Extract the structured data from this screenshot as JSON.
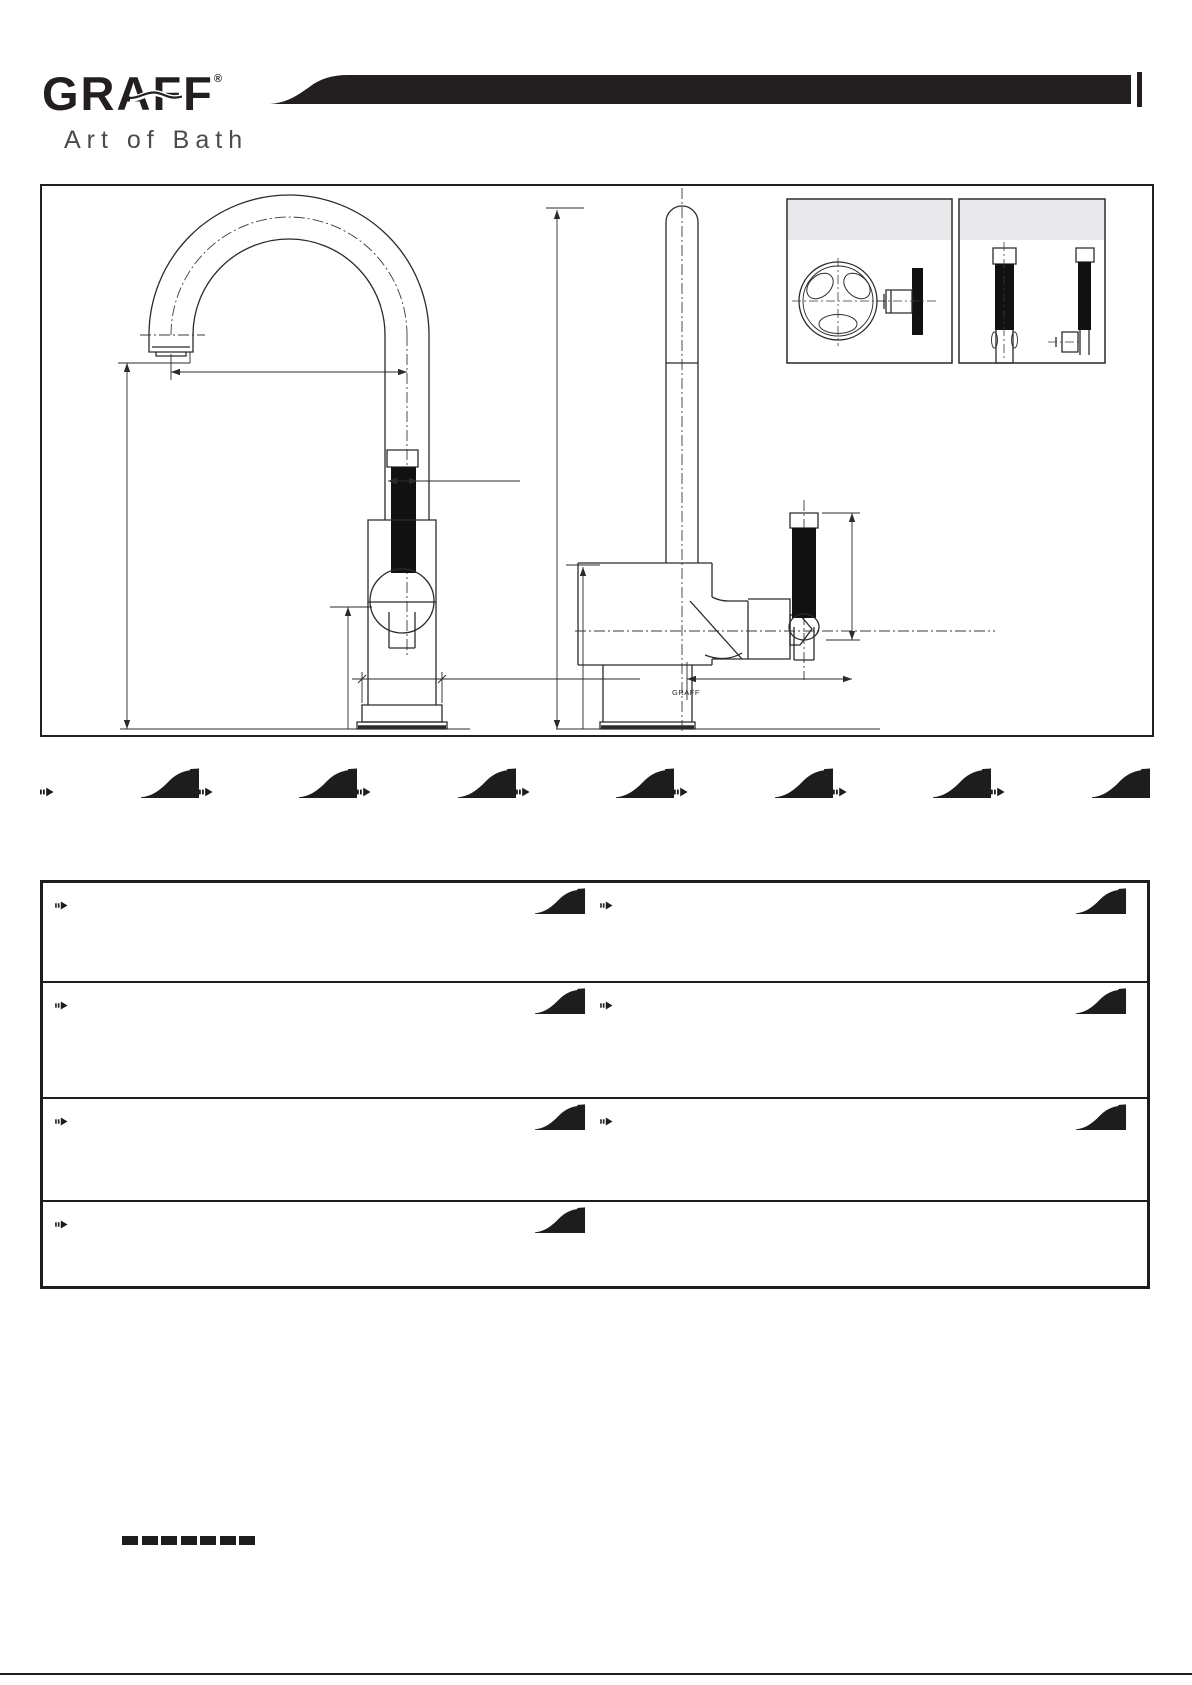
{
  "page": {
    "width": 1192,
    "height": 1685,
    "bg": "#ffffff",
    "ink": "#231f20"
  },
  "brand": {
    "logo_text": "GRAFF",
    "registered_mark": "®",
    "tagline": "Art of Bath"
  },
  "banner": {
    "color": "#231f20"
  },
  "drawing": {
    "border_color": "#231f20",
    "panel_header_fill": "#e9e9eb",
    "line_color": "#2b2b2b",
    "body_label": "GRAFF",
    "views": [
      {
        "name": "front-elevation"
      },
      {
        "name": "side-elevation"
      }
    ],
    "detail_panels": [
      {
        "name": "cross-handle-option"
      },
      {
        "name": "lever-handle-option"
      }
    ]
  },
  "divider_row": {
    "sections": 7
  },
  "table": {
    "border_color": "#1d1d1d",
    "rows": [
      {
        "cells": [
          {
            "icons": [
              "arrow",
              "wave"
            ]
          },
          {
            "icons": [
              "arrow",
              "wave"
            ]
          }
        ]
      },
      {
        "cells": [
          {
            "icons": [
              "arrow",
              "wave"
            ]
          },
          {
            "icons": [
              "arrow",
              "wave"
            ]
          }
        ]
      },
      {
        "cells": [
          {
            "icons": [
              "arrow",
              "wave"
            ]
          },
          {
            "icons": [
              "arrow",
              "wave"
            ]
          }
        ]
      },
      {
        "cells": [
          {
            "icons": [
              "arrow",
              "wave"
            ]
          },
          {
            "icons": []
          }
        ]
      }
    ]
  },
  "footer": {
    "dash_count": 7
  }
}
